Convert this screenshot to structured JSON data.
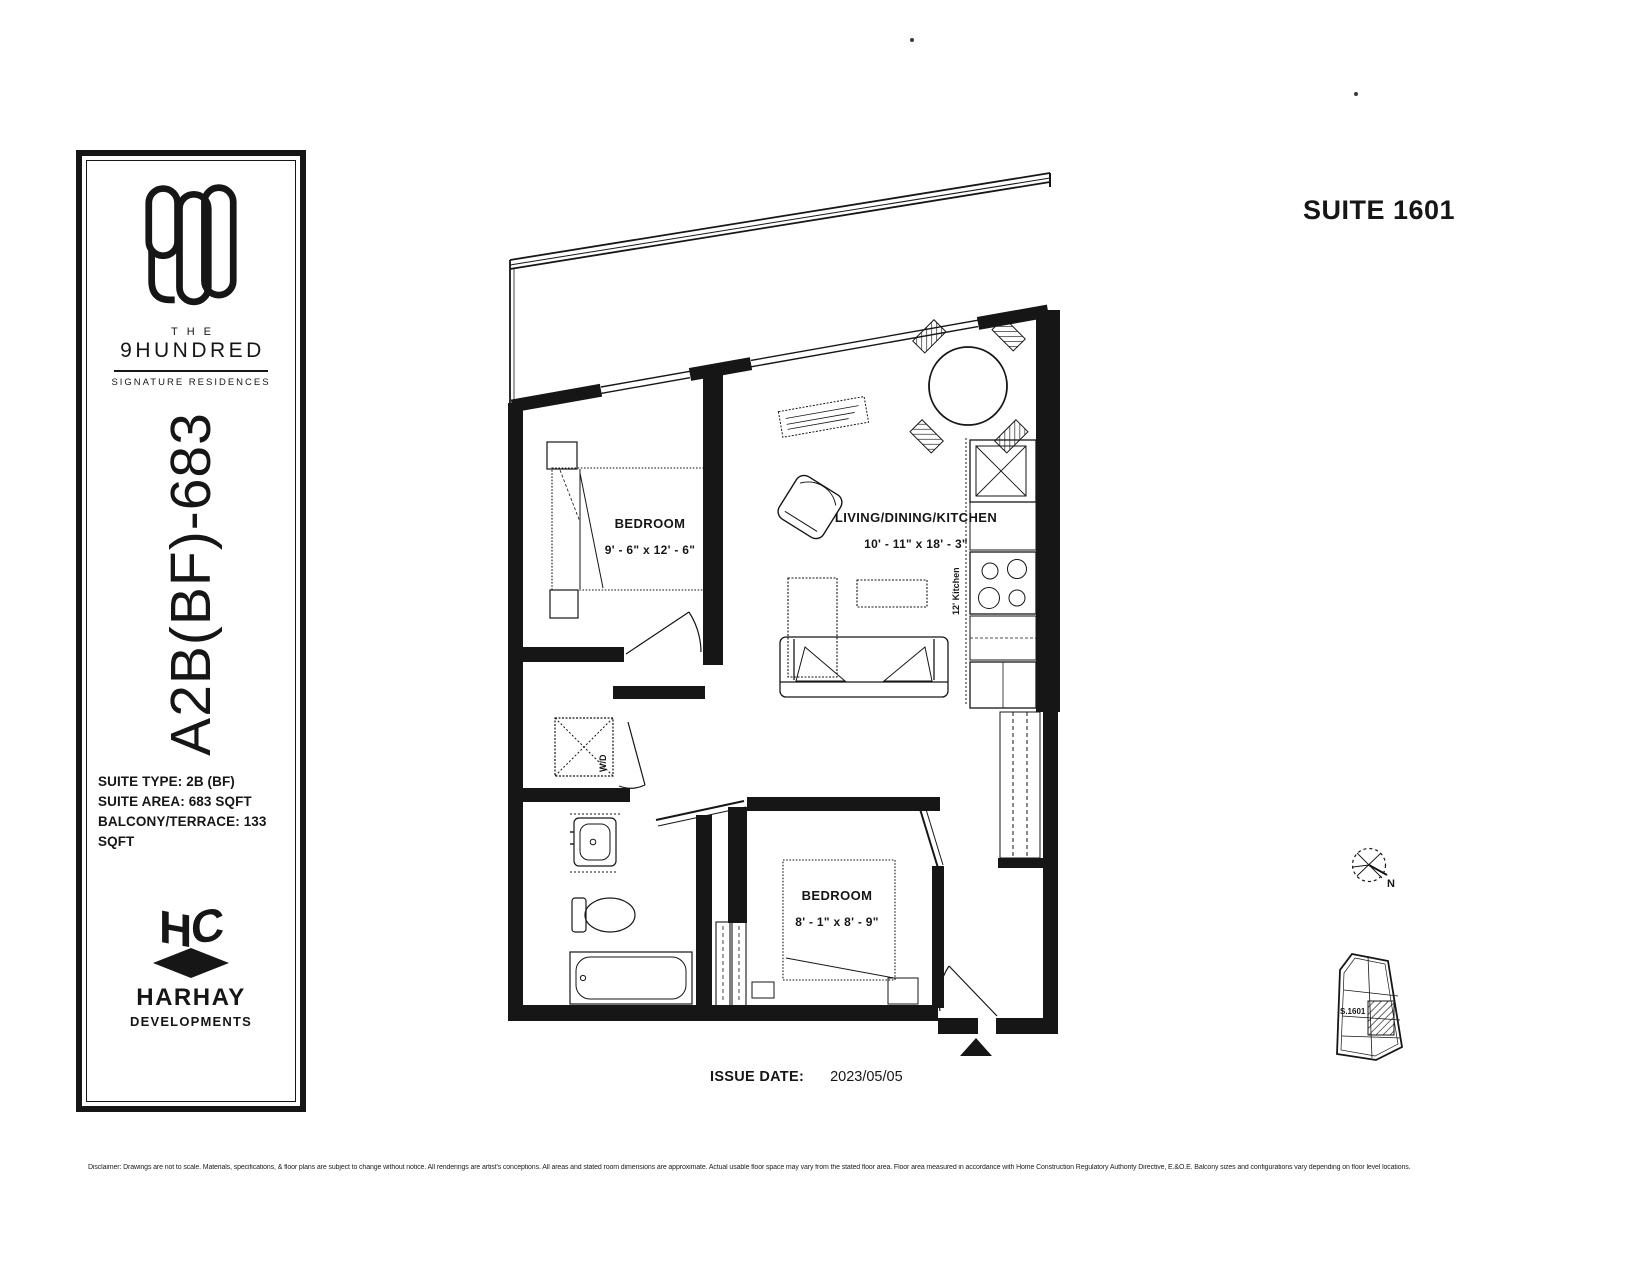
{
  "header": {
    "suite_title": "SUITE 1601"
  },
  "sidebar": {
    "logo_number": "900",
    "brand_prefix": "THE",
    "brand_name": "9HUNDRED",
    "brand_tagline": "SIGNATURE RESIDENCES",
    "plan_code": "A2B(BF)-683",
    "info_lines": [
      "SUITE TYPE: 2B (BF)",
      "SUITE AREA: 683 SQFT",
      "BALCONY/TERRACE: 133 SQFT"
    ],
    "monogram": {
      "h": "H",
      "c": "C"
    },
    "developer_name": "HARHAY",
    "developer_subtitle": "DEVELOPMENTS"
  },
  "floorplan": {
    "rooms": [
      {
        "name": "BEDROOM",
        "dims": "9' - 6\" x 12' - 6\""
      },
      {
        "name": "LIVING/DINING/KITCHEN",
        "dims": "10' - 11\" x 18' - 3\""
      },
      {
        "name": "BEDROOM",
        "dims": "8' - 1\" x 8' - 9\""
      }
    ],
    "washer_dryer_label": "W/D",
    "kitchen_label": "12' Kitchen",
    "compass_label": "N",
    "keyplan_label": "S.1601"
  },
  "footer": {
    "issue_date_label": "ISSUE DATE:",
    "issue_date_value": "2023/05/05",
    "disclaimer": "Disclaimer: Drawings are not to scale. Materials, specifications, & floor plans are subject to change without notice. All renderings are artist's conceptions. All areas and stated room dimensions are approximate. Actual usable floor space may vary from the stated floor area. Floor area measured in accordance with Home Construction Regulatory Authority Directive, E.&O.E. Balcony sizes and configurations vary depending on floor level locations."
  },
  "colors": {
    "ink": "#161616",
    "paper": "#ffffff"
  }
}
